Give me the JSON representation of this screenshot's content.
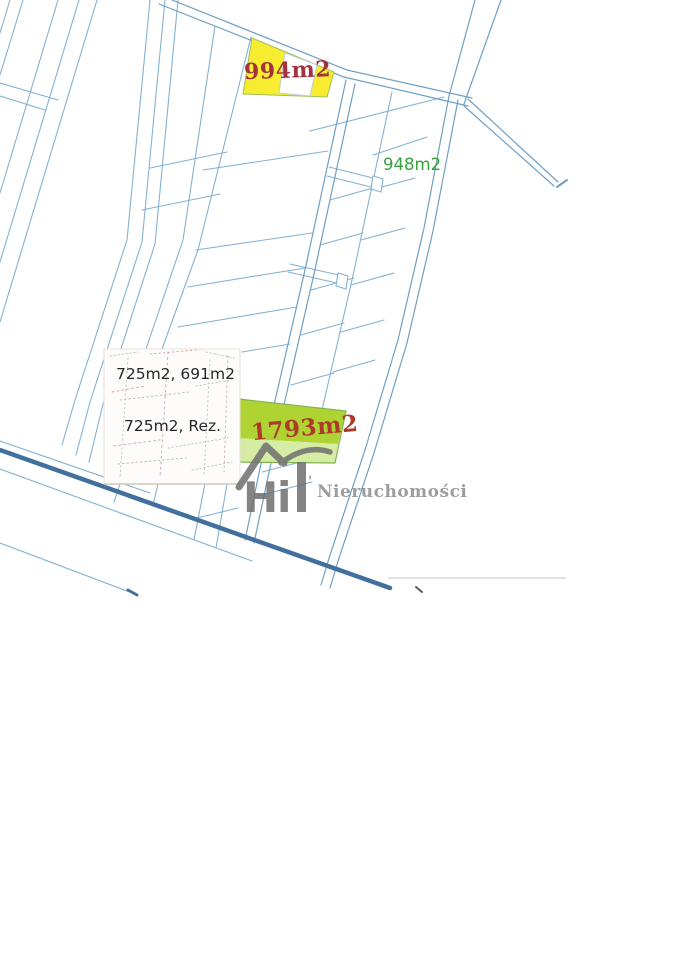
{
  "map": {
    "plots": {
      "yellow": {
        "area_label": "994m2",
        "fill": "#f7ec2f",
        "label_color": "#a4323e"
      },
      "green_small": {
        "area_label": "948m2",
        "label_color": "#35a23b"
      },
      "green_big": {
        "area_label": "1793m2",
        "fill": "#aed333",
        "fill_light": "#d6eba4",
        "border": "#7fb54e",
        "label_color": "#ac3a27"
      }
    },
    "inset": {
      "line1": "725m2, 691m2",
      "line2": "725m2, Rez.",
      "text_color": "#26262a",
      "background": "#fdfcfa"
    },
    "watermark": {
      "tick": "'",
      "logo_letter_h": "H",
      "logo_letter_i": "i",
      "brand": "Nieruchomości",
      "logo_color": "#6f6f6f",
      "brand_color": "#8d8d8d"
    },
    "colors": {
      "line": "#84b1d3",
      "road_line": "#6f9fc4",
      "thick_road": "#41709f",
      "gray_line": "#d9d9d9"
    }
  }
}
